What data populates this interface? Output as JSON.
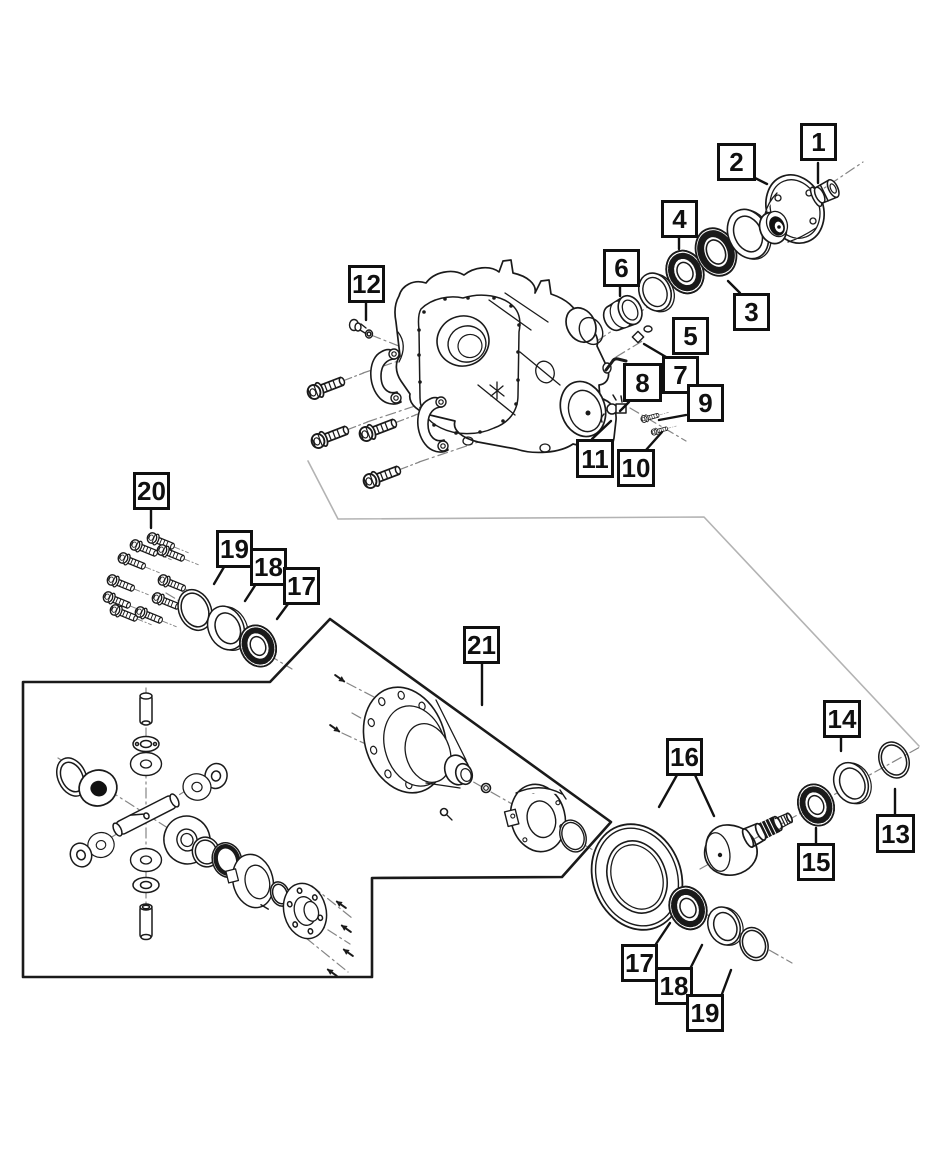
{
  "diagram": {
    "kind": "exploded-parts-diagram",
    "colors": {
      "line": "#1a1a1a",
      "separator": "#b3b3b3",
      "centerline": "#858585",
      "background": "#ffffff"
    },
    "callouts": {
      "c1": "1",
      "c2": "2",
      "c3": "3",
      "c4": "4",
      "c5": "5",
      "c6": "6",
      "c7": "7",
      "c8": "8",
      "c9": "9",
      "c10": "10",
      "c11": "11",
      "c12": "12",
      "c13": "13",
      "c14": "14",
      "c15": "15",
      "c16": "16",
      "c17": "17",
      "c18": "18",
      "c19": "19",
      "c20": "20",
      "c21": "21",
      "c17b": "17",
      "c18b": "18",
      "c19b": "19"
    }
  }
}
